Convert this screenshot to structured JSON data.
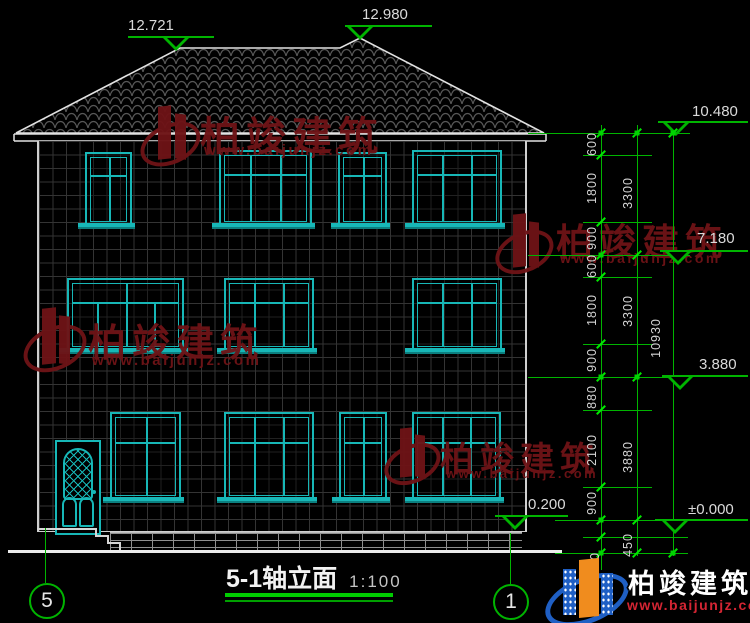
{
  "drawing": {
    "title": "5-1轴立面",
    "scale": "1:100",
    "axis_left": "5",
    "axis_right": "1"
  },
  "levels": {
    "roof_minor": "12.721",
    "roof_ridge": "12.980",
    "eave": "10.480",
    "floor3": "7.180",
    "floor2": "3.880",
    "plinth": "0.200",
    "ground": "±0.000"
  },
  "dimensions": {
    "segments": [
      "600",
      "1800",
      "900",
      "600",
      "1800",
      "900",
      "880",
      "2100",
      "900",
      "450",
      "450"
    ],
    "groups": [
      "3300",
      "3300",
      "3880"
    ],
    "overall": "10930"
  },
  "watermark": {
    "brand": "柏竣建筑",
    "url": "www.baijunjz.com"
  },
  "logo": {
    "brand": "柏竣建筑",
    "url": "www.baijunjz.com"
  },
  "colors": {
    "dimension_green": "#00b400",
    "cad_teal": "#17b7b7",
    "watermark_red": "#6e1316",
    "logo_blue": "#1f5fc4",
    "logo_orange": "#f08c1e",
    "logo_url_red": "#d42533"
  }
}
